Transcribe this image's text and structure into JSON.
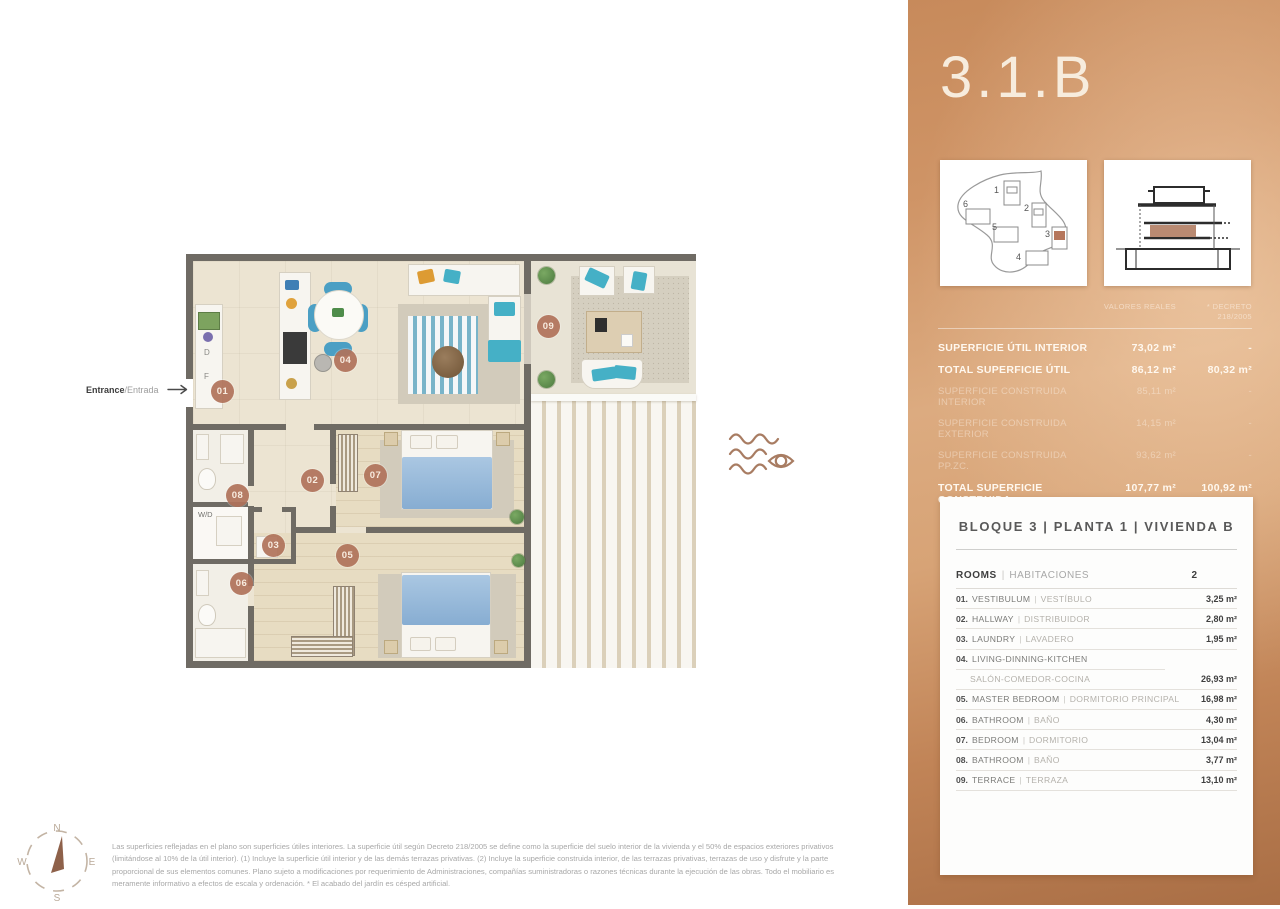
{
  "floor_plan": {
    "entrance": {
      "en": "Entrance",
      "es": "/Entrada"
    },
    "badges": [
      "01",
      "02",
      "03",
      "04",
      "05",
      "06",
      "07",
      "08",
      "09"
    ],
    "labels": {
      "washer_dryer": "W/D",
      "dishwasher": "D",
      "fridge": "F"
    }
  },
  "sidebar": {
    "unit_title": "3.1.B",
    "site_numbers": [
      "1",
      "2",
      "3",
      "4",
      "5",
      "6"
    ],
    "surface_table": {
      "col_real": "VALORES REALES",
      "col_decreto": "* DECRETO 218/2005",
      "rows": [
        {
          "label": "SUPERFICIE ÚTIL INTERIOR",
          "real": "73,02 m²",
          "decreto": "-"
        },
        {
          "label": "TOTAL SUPERFICIE ÚTIL",
          "real": "86,12 m²",
          "decreto": "80,32 m²"
        },
        {
          "label": "SUPERFICIE CONSTRUIDA INTERIOR",
          "real": "85,11 m²",
          "decreto": "-"
        },
        {
          "label": "SUPERFICIE CONSTRUIDA EXTERIOR",
          "real": "14,15 m²",
          "decreto": "-"
        },
        {
          "label": "SUPERFICIE CONSTRUIDA PP.ZC.",
          "real": "93,62 m²",
          "decreto": "-"
        },
        {
          "label": "TOTAL SUPERFICIE CONSTRUIDA",
          "real": "107,77 m²",
          "decreto": "100,92 m²"
        }
      ]
    },
    "unit_card": {
      "title": "BLOQUE 3  |  PLANTA 1  |  VIVIENDA B",
      "sep": "|",
      "rooms_header": {
        "en": "ROOMS",
        "es": "HABITACIONES",
        "count": "2"
      },
      "rooms": [
        {
          "num": "01.",
          "en": "VESTIBULUM",
          "es": "VESTÍBULO",
          "area": "3,25 m²"
        },
        {
          "num": "02.",
          "en": "HALLWAY",
          "es": "DISTRIBUIDOR",
          "area": "2,80 m²"
        },
        {
          "num": "03.",
          "en": "LAUNDRY",
          "es": "LAVADERO",
          "area": "1,95 m²"
        },
        {
          "num": "04.",
          "en": "LIVING-DINNING-KITCHEN",
          "es": "SALÓN-COMEDOR-COCINA",
          "area": "26,93 m²"
        },
        {
          "num": "05.",
          "en": "MASTER BEDROOM",
          "es": "DORMITORIO PRINCIPAL",
          "area": "16,98 m²"
        },
        {
          "num": "06.",
          "en": "BATHROOM",
          "es": "BAÑO",
          "area": "4,30 m²"
        },
        {
          "num": "07.",
          "en": "BEDROOM",
          "es": "DORMITORIO",
          "area": "13,04 m²"
        },
        {
          "num": "08.",
          "en": "BATHROOM",
          "es": "BAÑO",
          "area": "3,77 m²"
        },
        {
          "num": "09.",
          "en": "TERRACE",
          "es": "TERRAZA",
          "area": "13,10 m²"
        }
      ]
    }
  },
  "footer": {
    "compass": {
      "n": "N",
      "e": "E",
      "s": "S",
      "w": "W"
    },
    "disclaimer": "Las superficies reflejadas en el plano son superficies útiles interiores. La superficie útil según Decreto 218/2005 se define como la superficie del suelo interior de la vivienda y el 50% de espacios exteriores privativos (limitándose al 10% de la útil interior). (1) Incluye la superficie útil interior y de las demás terrazas privativas. (2) Incluye la superficie construida interior, de las terrazas privativas, terrazas de uso y disfrute y la parte proporcional de sus elementos comunes. Plano sujeto a modificaciones por requerimiento de Administraciones, compañías suministradoras o razones técnicas durante la ejecución de las obras. Todo el mobiliario es meramente informativo a efectos de escala y ordenación. * El acabado del jardín es césped artificial."
  },
  "colors": {
    "accent": "#b5765c",
    "copper": "#cf9466",
    "wall": "#6f6b64"
  }
}
